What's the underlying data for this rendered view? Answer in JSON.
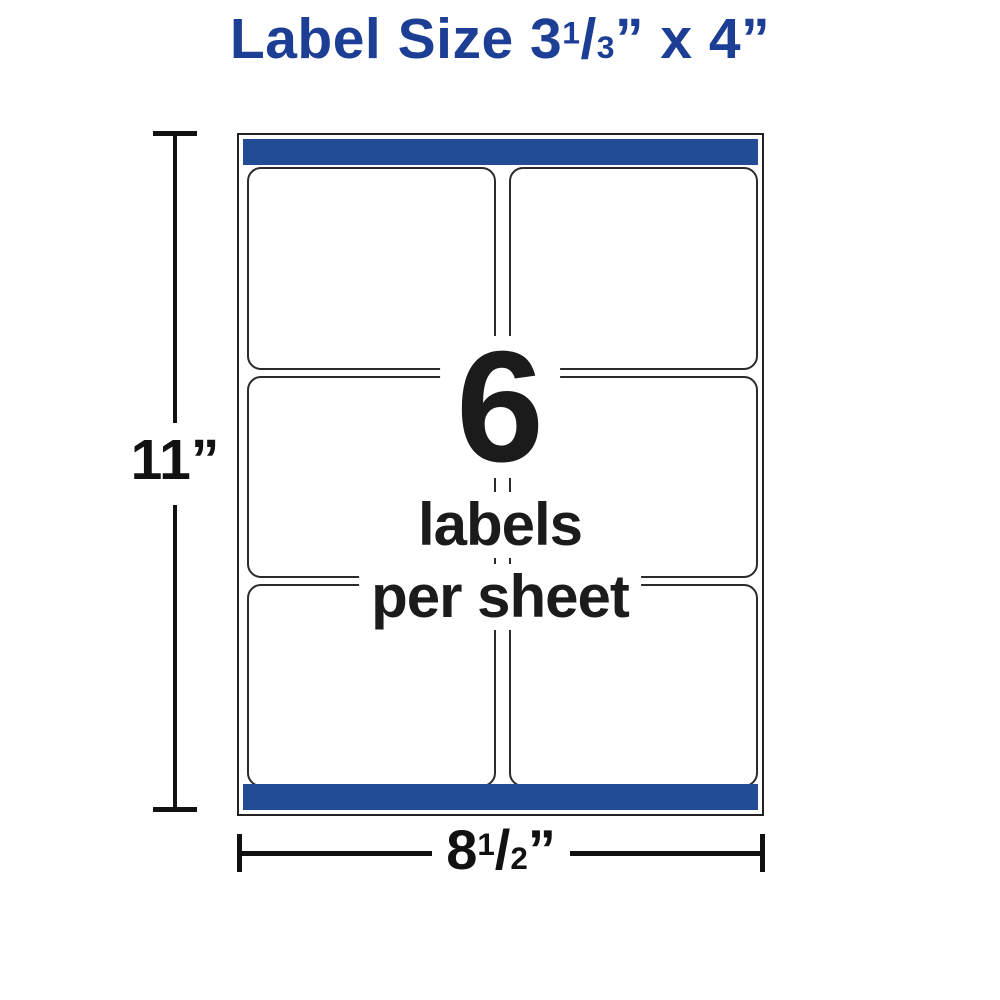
{
  "title": {
    "prefix": "Label Size 3",
    "fraction": {
      "numerator": "1",
      "slash": "/",
      "denominator": "3"
    },
    "suffix": "” x 4”"
  },
  "sheet": {
    "labels_total": 6,
    "grid_rows": 3,
    "grid_cols": 2,
    "overlay": {
      "count": "6",
      "caption_line1": "labels",
      "caption_line2": "per sheet"
    }
  },
  "dimensions": {
    "height_label": "11”",
    "width_label": {
      "whole": "8",
      "fraction": {
        "numerator": "1",
        "slash": "/",
        "denominator": "2"
      },
      "quote": "”"
    }
  },
  "colors": {
    "title_blue": "#1c3e94",
    "strip_blue": "#224d96",
    "ink": "#111111"
  }
}
